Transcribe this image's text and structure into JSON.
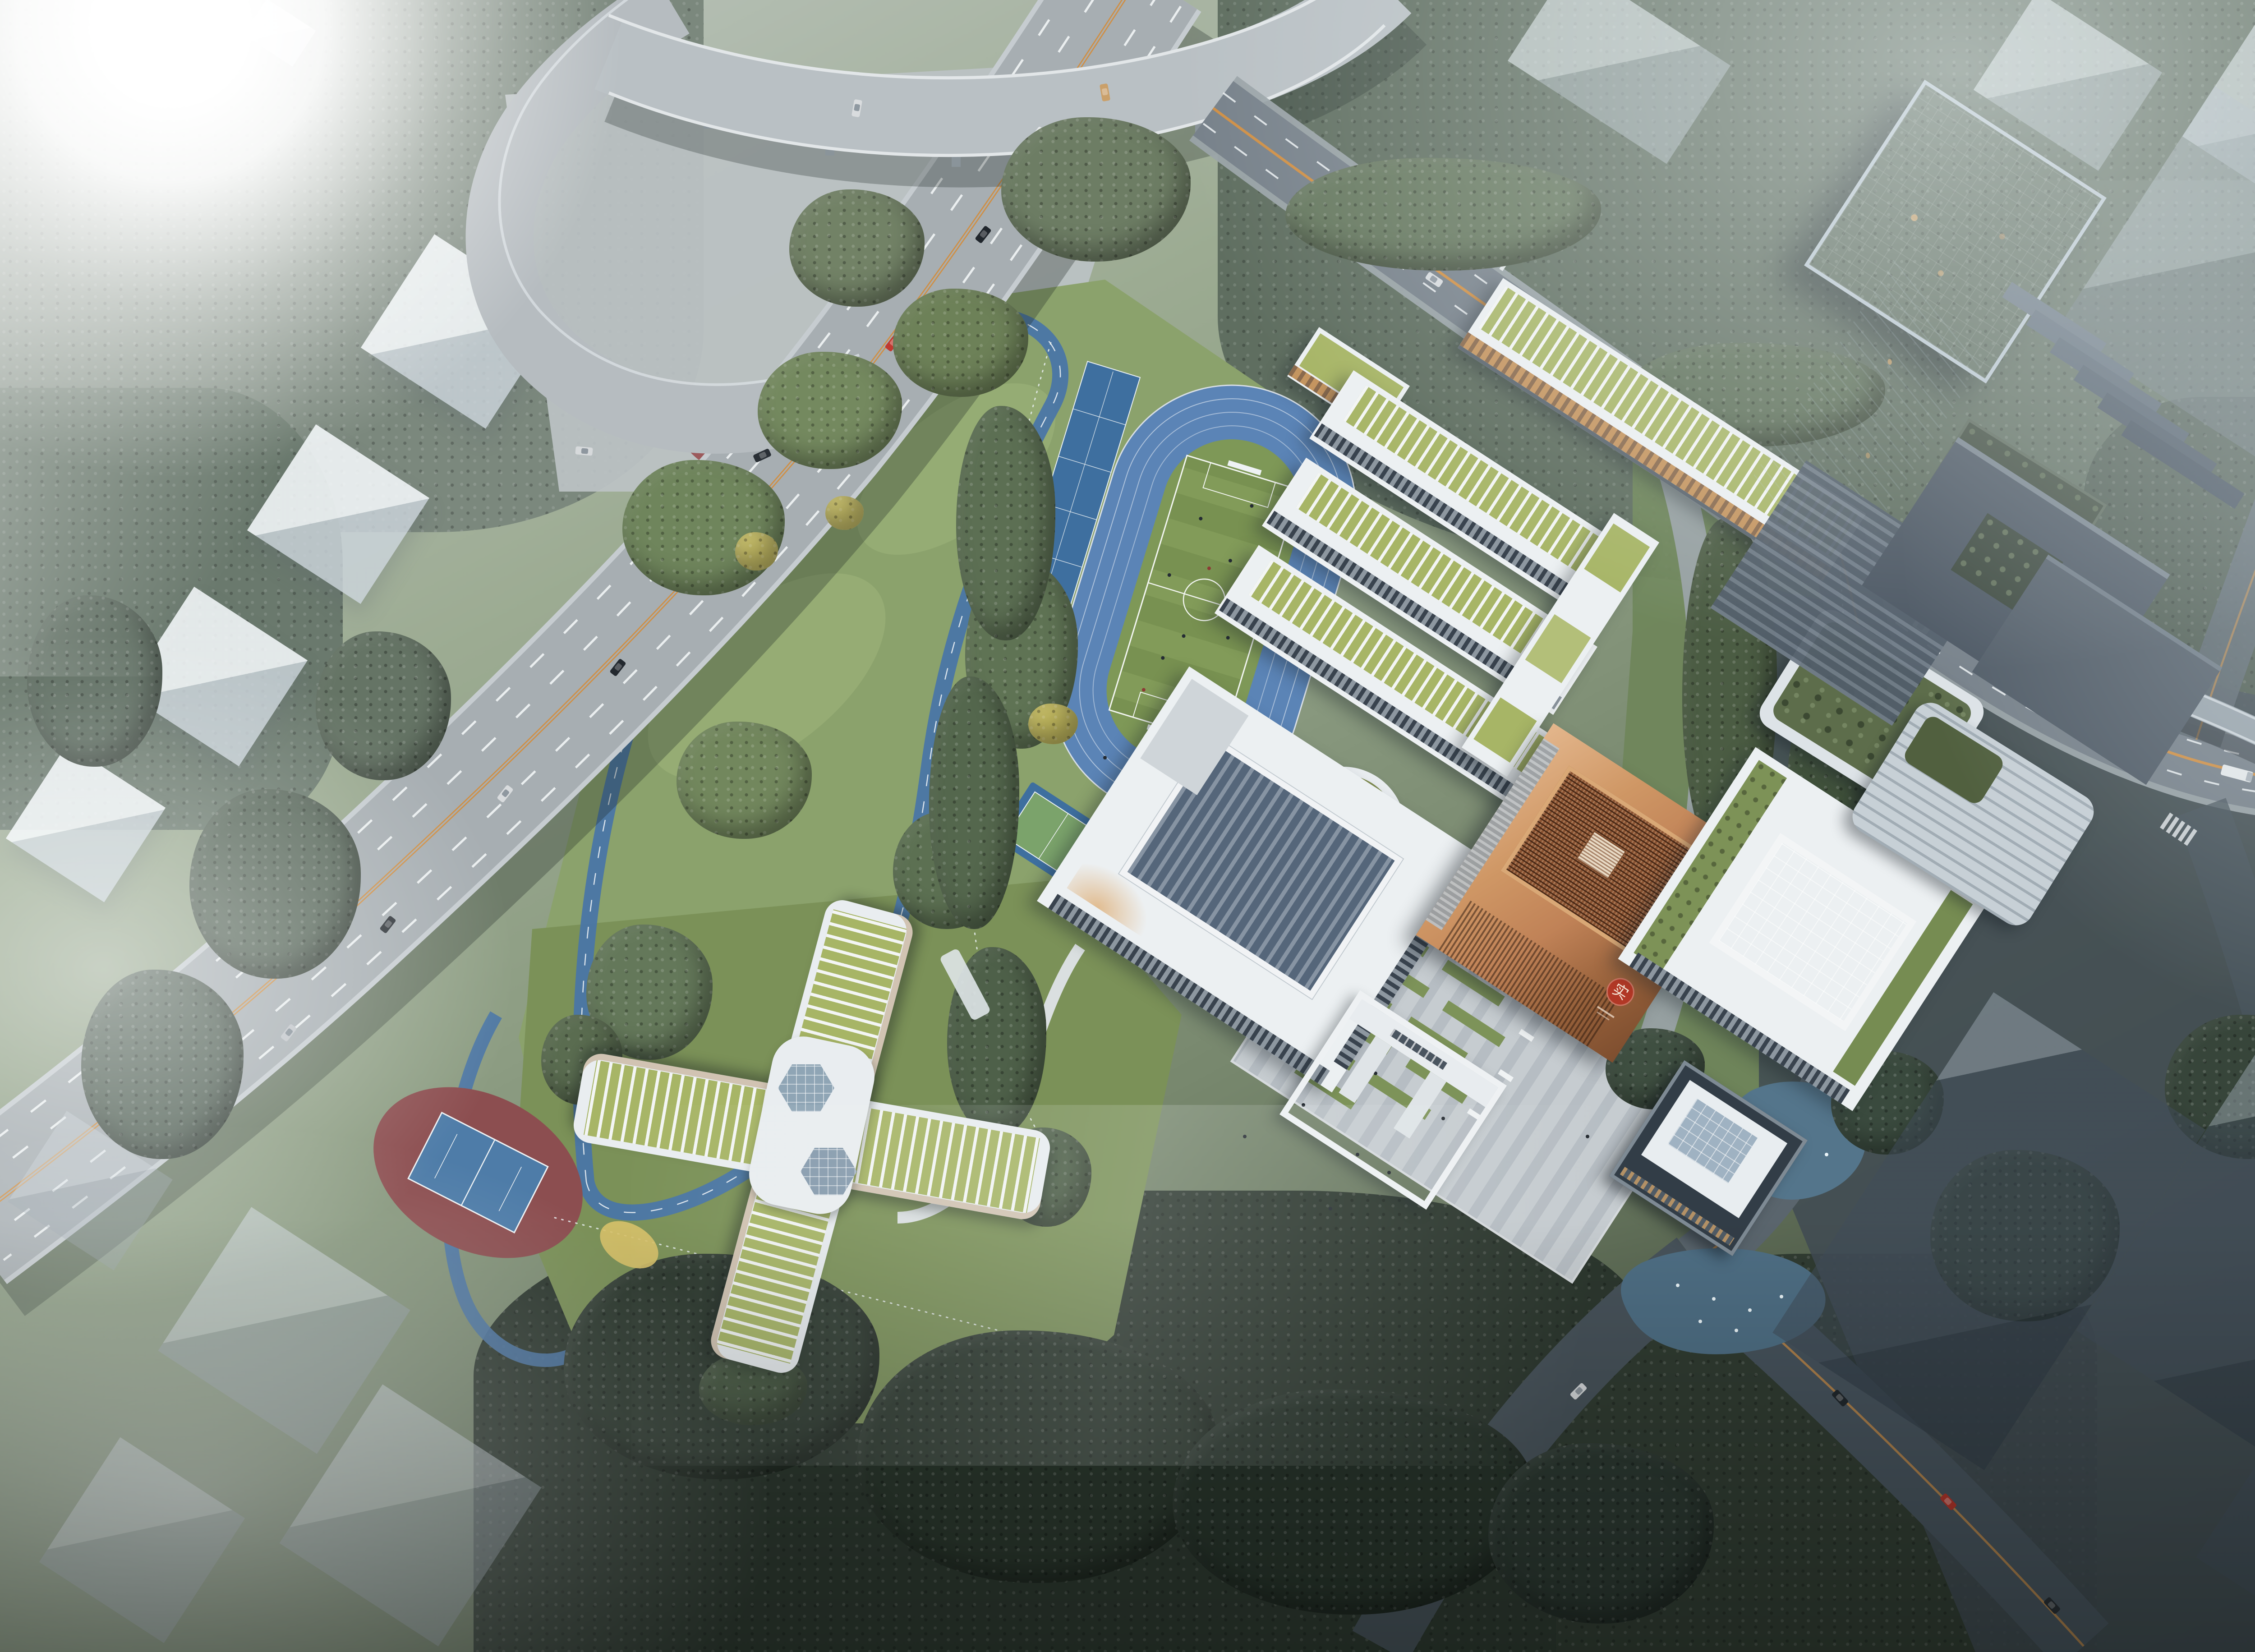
{
  "scene": {
    "type": "aerial-architectural-rendering",
    "subject": "school campus masterplan beside an elevated expressway at hazy dawn",
    "view": "bird's-eye oblique",
    "weather": "low fog over surrounding city blocks, sun glare upper left"
  },
  "palette": {
    "haze": "#c3cdcc",
    "sun": "#ffffff",
    "forest_dark": "#2c372e",
    "forest_mid": "#55645a",
    "forest_light": "#7b887d",
    "park_lawn": "#8ba26c",
    "lawn_dark": "#70855a",
    "field_green": "#7e9857",
    "track_blue": "#5b84b6",
    "court_blue": "#3e6f9f",
    "court_green": "#7ba36b",
    "court_red": "#9c5a5c",
    "tennis_red": "#8c4e50",
    "jog_blue": "#4a76a6",
    "highway_gray": "#a7aeb2",
    "road_gray": "#77818a",
    "road_dark": "#47525a",
    "plaza_gray": "#c6ccd0",
    "paving_stripe": "#b6bdc3",
    "building_white": "#ecf0f2",
    "roof_green": "#a7b566",
    "facade_orange": "#c08a4e",
    "copper": "#c08257",
    "copper_dark": "#8a5332",
    "seal_red": "#b23826",
    "louvre_dark": "#55667a",
    "tower_glass": "#33415a",
    "tower_light": "#b9c6cf",
    "pond": "#54758b",
    "ginkgo": "#c6bd66",
    "marking_orange": "#cf8f45",
    "ghost_white": "rgba(236,242,245,0.8)"
  },
  "emblem": {
    "seal_character": "实",
    "seal_color": "#b23826"
  },
  "campus": {
    "stadium": {
      "kind": "running-track",
      "lanes": 6,
      "infield": "soccer-field",
      "goals": 2
    },
    "courts": {
      "basketball": 3,
      "multi_court_strip": 1,
      "park_half_court": 1,
      "tennis": 1
    },
    "buildings": [
      {
        "id": "north-teaching-building",
        "roof": "green",
        "floors": 5
      },
      {
        "id": "teaching-wings",
        "count": 3,
        "roof": "green-pergola",
        "link": "east-spine"
      },
      {
        "id": "circular-sunken-courtyard",
        "shape": "ring"
      },
      {
        "id": "auditorium-gymnasium",
        "roof": "louvered"
      },
      {
        "id": "copper-library-cube",
        "facade": "carved-lattice",
        "emblem": "red-seal"
      },
      {
        "id": "skylight-hall",
        "roof": "glass-grid"
      },
      {
        "id": "entrance-gate",
        "type": "portal"
      },
      {
        "id": "water-pavilion",
        "ponds": 2,
        "fountain_jets": 10
      },
      {
        "id": "kindergarten-x-building",
        "wings": 4,
        "skylights": 2
      },
      {
        "id": "office-tower",
        "facade": "dark-glass",
        "podium": "terraced",
        "bridge": true
      },
      {
        "id": "mid-rise-garden-buildings",
        "count": 2
      }
    ],
    "landscape": {
      "jogging_loop": "blue",
      "plaza_strips": "green",
      "ginkgo_trees": "yellow"
    }
  },
  "infrastructure": {
    "elevated_expressway": {
      "lanes": 8,
      "median": "double-orange"
    },
    "ramps": 3,
    "city_roads": 6,
    "crosswalks": 4,
    "pedestrian_bridge": 1,
    "vehicles": {
      "cars": 34,
      "bus": 1,
      "truck": 1
    }
  }
}
